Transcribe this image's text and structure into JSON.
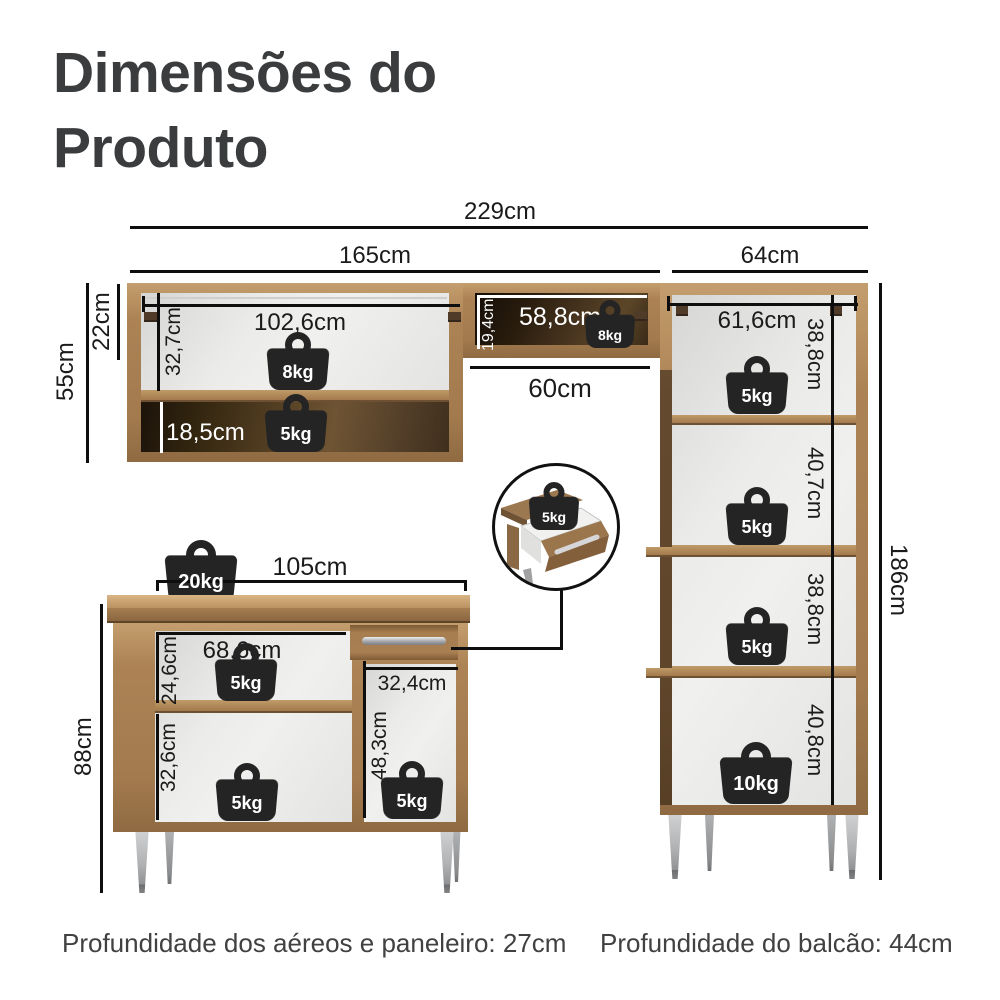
{
  "title": "Dimensões do Produto",
  "top_dimensions": {
    "total_width": "229cm",
    "upper_section_width": "165cm",
    "tall_cabinet_width": "64cm"
  },
  "upper_cabinet": {
    "height": "55cm",
    "top_offset": "22cm",
    "interior_width": "102,6cm",
    "interior_height": "32,7cm",
    "lower_shelf_height": "18,5cm",
    "top_capacity": "8kg",
    "lower_capacity": "5kg"
  },
  "middle_shelf": {
    "interior_width": "58,8cm",
    "interior_height": "19,4cm",
    "capacity": "8kg",
    "clearance_width": "60cm"
  },
  "tall_cabinet": {
    "interior_width": "61,6cm",
    "total_height": "186cm",
    "sections": [
      {
        "height": "38,8cm",
        "capacity": "5kg"
      },
      {
        "height": "40,7cm",
        "capacity": "5kg"
      },
      {
        "height": "38,8cm",
        "capacity": "5kg"
      },
      {
        "height": "40,8cm",
        "capacity": "10kg"
      }
    ]
  },
  "base_cabinet": {
    "width": "105cm",
    "height": "88cm",
    "top_capacity": "20kg",
    "left_interior_width": "68,6cm",
    "upper_shelf_height": "24,6cm",
    "upper_shelf_capacity": "5kg",
    "lower_shelf_height": "32,6cm",
    "lower_shelf_capacity": "5kg",
    "right_opening_width": "32,4cm",
    "right_opening_height": "48,3cm",
    "right_opening_capacity": "5kg"
  },
  "drawer_detail": {
    "capacity": "5kg"
  },
  "footnotes": {
    "upper_depth": "Profundidade dos aéreos e paneleiro: 27cm",
    "base_depth": "Profundidade do balcão: 44cm"
  },
  "colors": {
    "wood": "#b3895a",
    "dark_interior": "#3c2c18",
    "weight_icon": "#242424",
    "dimension_line": "#0e0e0e"
  }
}
